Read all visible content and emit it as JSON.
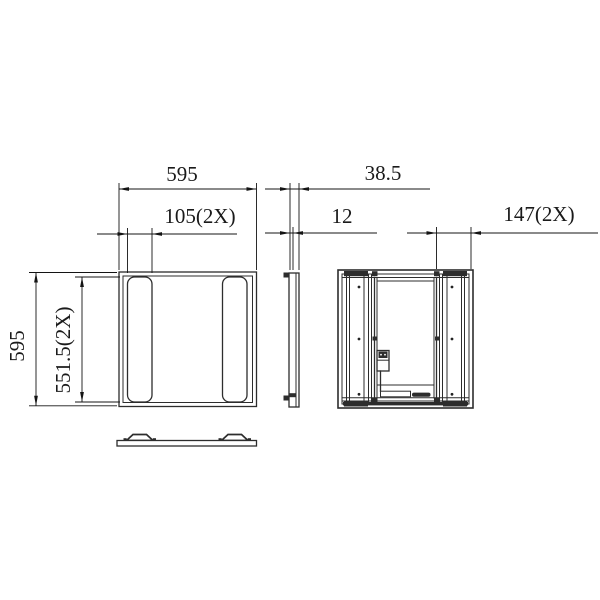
{
  "colors": {
    "background": "#ffffff",
    "geometry_line": "#2d2d2d",
    "dimension_line": "#141414",
    "text": "#1a1a1a"
  },
  "dim_labels": {
    "panel_width": "595",
    "slot_width": "105(2X)",
    "overall_depth": "38.5",
    "frame_thickness": "12",
    "side_channel_width": "147(2X)",
    "panel_height": "595",
    "slot_length": "551.5(2X)"
  }
}
